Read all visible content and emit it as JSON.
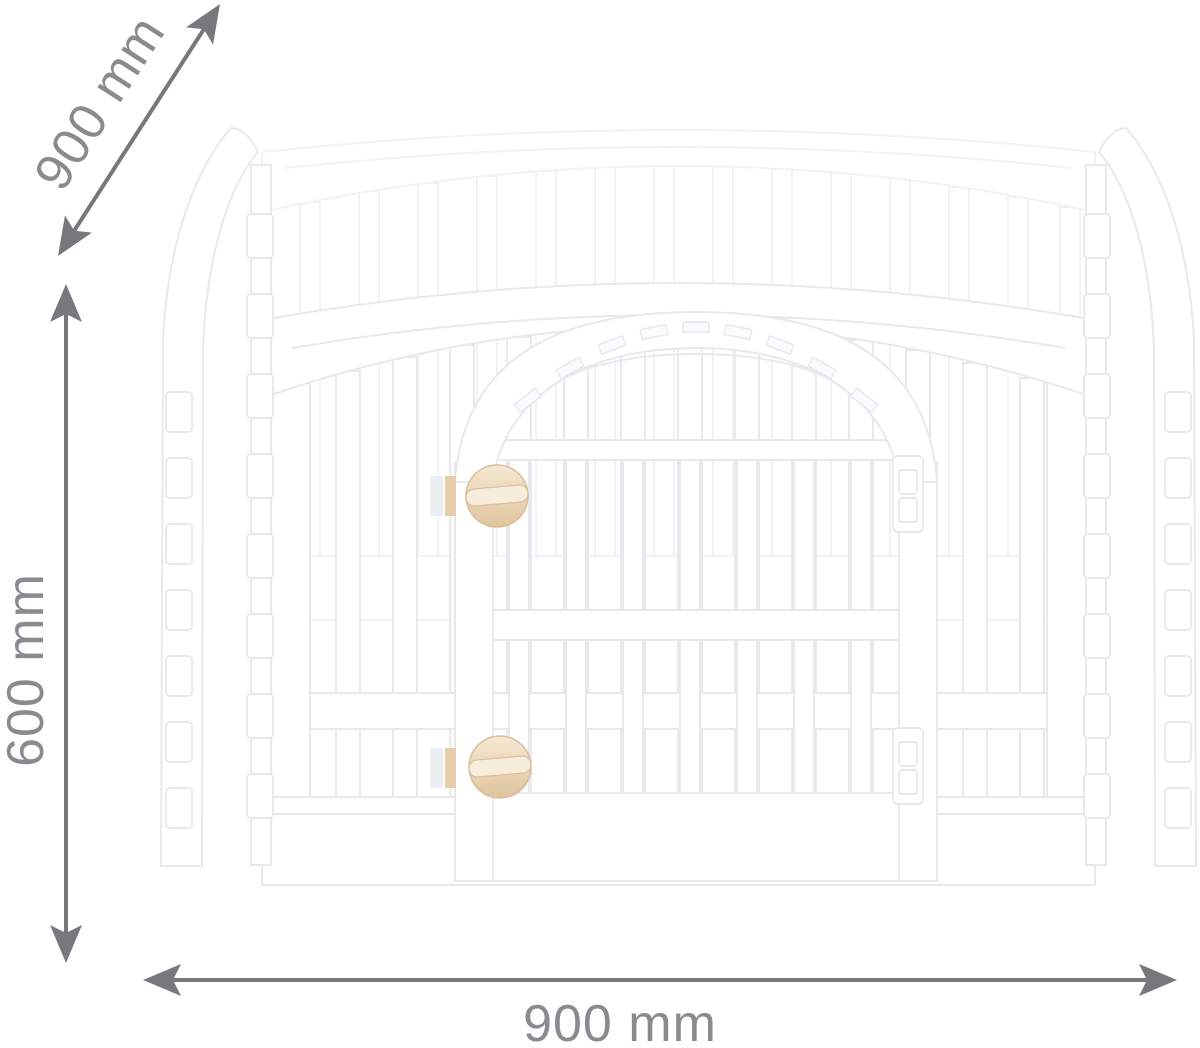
{
  "figure": {
    "type": "product-dimension-diagram",
    "subject": "four-panel-pet-playpen-with-door"
  },
  "dimensions": {
    "depth": {
      "label": "900 mm",
      "orientation": "diagonal"
    },
    "height": {
      "label": "600 mm",
      "orientation": "vertical"
    },
    "width": {
      "label": "900 mm",
      "orientation": "horizontal"
    }
  },
  "colors": {
    "background": "#ffffff",
    "arrow": "#77787b",
    "label": "#8a8b8e",
    "pen_fill": "#ffffff",
    "pen_stroke": "#e7e9ed",
    "pen_stroke_faint": "#f1f2f5",
    "knob": "#e6cda9",
    "knob_light": "#f6eddd",
    "knob_stroke": "#d9bf9b"
  }
}
